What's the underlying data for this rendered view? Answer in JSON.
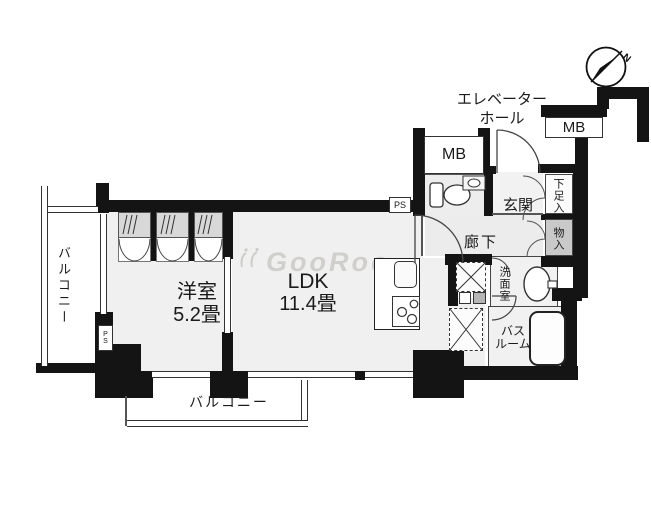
{
  "watermark": {
    "text": "GooRoo"
  },
  "compass": {
    "north_label": "N"
  },
  "rooms": {
    "elevator_hall": {
      "line1": "エレベーター",
      "line2": "ホール"
    },
    "mb_right": {
      "label": "MB"
    },
    "mb_left": {
      "label": "MB"
    },
    "entrance": {
      "label": "玄関"
    },
    "shoe_cabinet": {
      "label": "下足入"
    },
    "corridor": {
      "label": "廊下"
    },
    "storage": {
      "label": "物入"
    },
    "washroom": {
      "label": "洗面室"
    },
    "bathroom": {
      "line1": "バス",
      "line2": "ルーム"
    },
    "ldk": {
      "label": "LDK",
      "size": "11.4畳"
    },
    "western_room": {
      "label": "洋室",
      "size": "5.2畳"
    },
    "balcony_left": {
      "label": "バルコニー"
    },
    "balcony_bottom": {
      "label": "バルコニー"
    },
    "ps_top": {
      "label": "PS"
    },
    "ps_left": {
      "label": "PS"
    }
  },
  "colors": {
    "wall": "#141414",
    "floor": "#f0f0f0",
    "storage_fill": "#c9c9c9"
  }
}
